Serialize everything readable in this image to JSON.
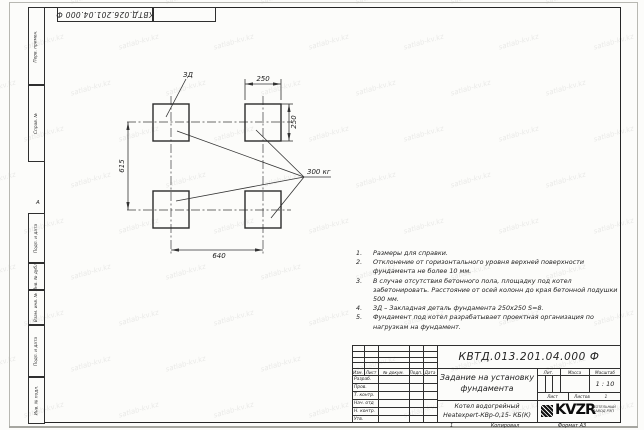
{
  "watermark": {
    "text": "satlab-kv.kz"
  },
  "corner_stamp": {
    "doc_number": "КВТД.026.201.04.000 Ф"
  },
  "zone_letter": "А",
  "margin_labels": {
    "perv_primen": "Перв. примен.",
    "sprav_no": "Справ. №",
    "podp_data_1": "Подп. и дата",
    "inv_dubl": "Инв. № дубл.",
    "vzam_inv": "Взам. инв. №",
    "podp_data_2": "Подп. и дата",
    "inv_podl": "Инв. № подл."
  },
  "drawing": {
    "zd_label": "ЗД",
    "load_label": "300 кг",
    "dim_width_top": "250",
    "dim_height_right": "250",
    "dim_left": "615",
    "dim_bottom": "640"
  },
  "notes": [
    {
      "num": "1.",
      "text": "Размеры для справки."
    },
    {
      "num": "2.",
      "text": "Отклонение от горизонтального уровня верхней поверхности фундамента не более 10 мм."
    },
    {
      "num": "3.",
      "text": "В случае отсутствия бетонного пола, площадку под котел забетонировать. Расстояние от осей колонн до края бетонной подушки 500 мм."
    },
    {
      "num": "4.",
      "text": "ЗД – Закладная деталь фундамента 250х250 S=8."
    },
    {
      "num": "5.",
      "text": "Фундамент под котел разрабатывает проектная организация по нагрузкам на фундамент."
    }
  ],
  "title_block": {
    "doc_number": "КВТД.013.201.04.000 Ф",
    "title_line1": "Задание на установку",
    "title_line2": "фундамента",
    "product_line1": "Котел водогрейный",
    "product_line2": "Heatexpert-КВр-0,15- КБ(К)",
    "col_izm": "Изм.",
    "col_list": "Лист",
    "col_doc": "№ докум.",
    "col_podp": "Подп.",
    "col_data": "Дата",
    "row_razrab": "Разраб.",
    "row_prov": "Пров.",
    "row_tkontr": "Т. контр.",
    "row_nachotd": "Нач. отд",
    "row_nkontr": "Н. контр.",
    "row_utv": "Утв.",
    "lit": "Лит.",
    "massa": "Масса",
    "masshtab": "Масштаб",
    "scale_value": "1 : 10",
    "list_label": "Лист",
    "listov_label": "Листов",
    "listov_value": "1",
    "logo_text": "KVZR",
    "logo_caption1": "КОТЕЛЬНЫЙ",
    "logo_caption2": "ЗАВОД РЭП",
    "footer_one": "1",
    "footer_copied": "Копировал",
    "footer_format": "Формат А3"
  }
}
